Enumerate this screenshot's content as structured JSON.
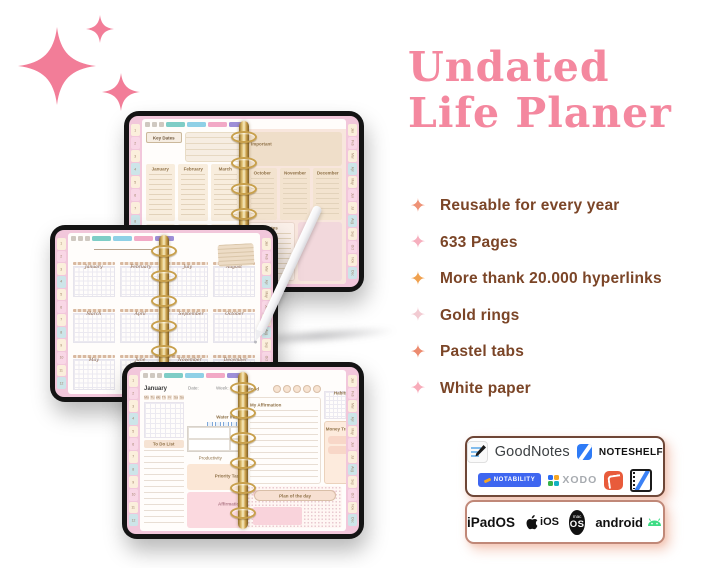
{
  "title": {
    "line1": "Undated",
    "line2": "Life Planer",
    "color": "#F4889F"
  },
  "decor": {
    "sparkle_color": "#F27D98"
  },
  "features": [
    {
      "label": "Reusable for every year",
      "star_color": "#EE9276"
    },
    {
      "label": "633 Pages",
      "star_color": "#F6AFBE"
    },
    {
      "label": "More thank 20.000 hyperlinks",
      "star_color": "#F0A14F"
    },
    {
      "label": "Gold rings",
      "star_color": "#F2CBD2"
    },
    {
      "label": "Pastel tabs",
      "star_color": "#EC8B6F"
    },
    {
      "label": "White paper",
      "star_color": "#F8ACBA"
    }
  ],
  "apps_box": {
    "goodnotes_label": "GoodNotes",
    "noteshelf_label": "NOTESHELF",
    "notability_label": "NOTABILITY",
    "xodo_label": "XODO",
    "xodo_mark_colors": [
      "#2B6BF3",
      "#F5A623",
      "#37B34A",
      "#12B2C4"
    ]
  },
  "os_box": {
    "ipados_label": "iPadOS",
    "ios_label": "iOS",
    "macos_small": "mac",
    "macos_label": "OS",
    "android_label": "android",
    "android_green": "#3DDC84"
  },
  "tablet_common": {
    "cover_pink": "#F2C7DB",
    "gold": "#C8A04C",
    "tab_colors": [
      "#FBEFDC",
      "#F9D7E6",
      "#FBEFDC",
      "#CDE5E9"
    ],
    "nav_chip_colors": [
      "#7ECDC6",
      "#8FD0E6",
      "#F2A9C6",
      "#9D8FD8"
    ],
    "side_tab_numbers": [
      "1",
      "2",
      "3",
      "4",
      "5",
      "6",
      "7",
      "8",
      "9",
      "10",
      "11",
      "12"
    ],
    "month_tabs": [
      "Jan",
      "Feb",
      "Mar",
      "Apr",
      "May",
      "Jun",
      "Jul",
      "Aug",
      "Sep",
      "Oct",
      "Nov",
      "Dec"
    ]
  },
  "tablet_yearly": {
    "key_dates_label": "Key Dates",
    "important_label": "Important",
    "notes_label": "Notes",
    "left_months": [
      "January",
      "February",
      "March",
      "April",
      "May",
      "June"
    ],
    "right_months": [
      "October",
      "November",
      "December"
    ]
  },
  "tablet_calendar": {
    "months": [
      "January",
      "February",
      "July",
      "August",
      "March",
      "April",
      "September",
      "October",
      "May",
      "June",
      "November",
      "December"
    ]
  },
  "tablet_daily": {
    "month_label": "January",
    "date_label": "Date:",
    "week_label": "Week:",
    "weekdays": [
      "Mo",
      "Tu",
      "We",
      "Th",
      "Fr",
      "Sa",
      "Su"
    ],
    "water_label": "Water Intake",
    "todo_label": "To Do List",
    "productivity_label": "Productivity",
    "stars": "☆☆☆☆☆",
    "priority_label": "Priority Tasks",
    "affirmation_label": "Affirmation",
    "mood_label": "Mood",
    "habits_label": "Habits",
    "my_affirmation_label": "My Affirmation",
    "money_label": "Money Tracker",
    "plan_label": "Plan of the day"
  }
}
